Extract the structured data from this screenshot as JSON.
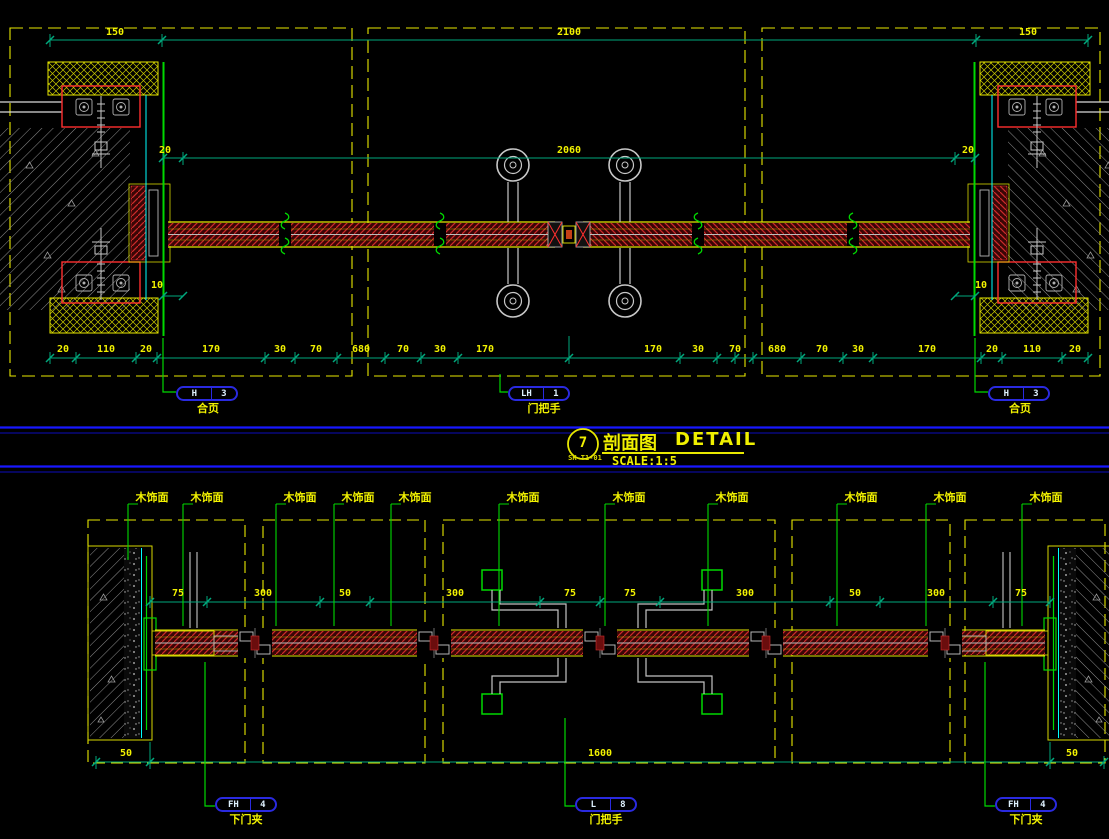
{
  "title_block": {
    "detail_number": "7",
    "detail_code": "SK-T1-01",
    "title_cn": "剖面图",
    "title_en": "DETAIL",
    "scale": "SCALE:1:5"
  },
  "top_drawing": {
    "dims_row1": [
      "150",
      "2100",
      "150"
    ],
    "dims_row2": [
      "20",
      "2060",
      "20"
    ],
    "dims_gap": [
      "10",
      "10"
    ],
    "dims_row3": [
      "20",
      "110",
      "20",
      "170",
      "30",
      "70",
      "680",
      "70",
      "30",
      "170",
      "170",
      "30",
      "70",
      "680",
      "70",
      "30",
      "170",
      "20",
      "110",
      "20"
    ],
    "tags": [
      {
        "code": "H",
        "index": "3",
        "label": "合页"
      },
      {
        "code": "LH",
        "index": "1",
        "label": "门把手"
      },
      {
        "code": "H",
        "index": "3",
        "label": "合页"
      }
    ]
  },
  "bottom_drawing": {
    "finish_label": "木饰面",
    "dims_row1": [
      "75",
      "300",
      "50",
      "300",
      "75",
      "75",
      "300",
      "50",
      "300",
      "75"
    ],
    "dims_row2": [
      "50",
      "1600",
      "50"
    ],
    "tags": [
      {
        "code": "FH",
        "index": "4",
        "label": "下门夹"
      },
      {
        "code": "L",
        "index": "8",
        "label": "门把手"
      },
      {
        "code": "FH",
        "index": "4",
        "label": "下门夹"
      }
    ]
  },
  "colors": {
    "background": "#000000",
    "dimension_line": "#00a87d",
    "dimension_text": "#f2f200",
    "dashed_box": "#e8e800",
    "annotation_green": "#00d900",
    "cyan_line": "#00ffff",
    "panel_hatch_red": "#cf2b2b",
    "fixing_box_red": "#ff2f2f",
    "detail_gray": "#c4c4c4",
    "tag_outline_blue": "#2a2ae0",
    "tag_text": "#dff2ff",
    "rule_blue": "#1818ff"
  }
}
